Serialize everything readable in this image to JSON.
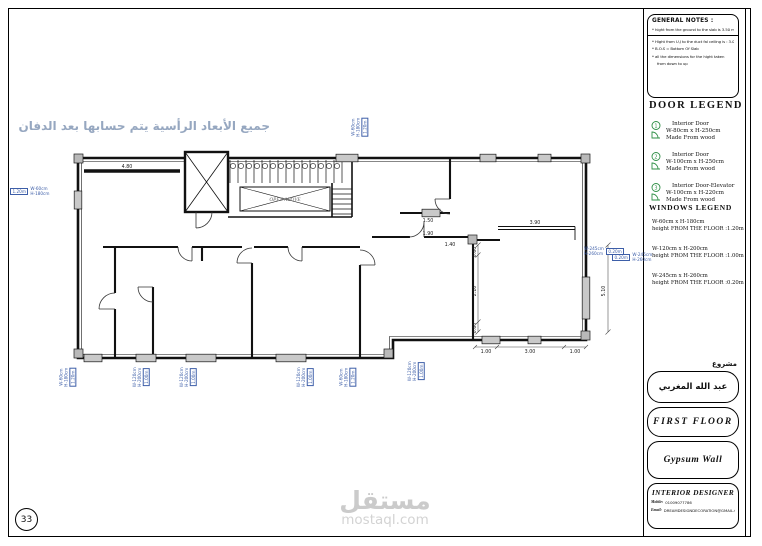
{
  "sheet": {
    "number": "33",
    "watermark_ar": "مستقل",
    "watermark_en": "mostaql.com"
  },
  "plan": {
    "note_arabic": "جميع الأبعاد الرأسية يتم حسابها بعد الدفان",
    "stair_label": "OPEN ABOVE",
    "dims": {
      "top_left": "4.80",
      "a": "1.50",
      "b": "1.90",
      "c": "1.40",
      "beam": "3.90",
      "v1": "0.60",
      "v2": "2.10",
      "v3": "0.60",
      "r1": "5.10",
      "b1": "1.00",
      "b2": "3.00",
      "b3": "1.00"
    },
    "window_tags": [
      {
        "l1": "W-60cm",
        "l2": "H-180cm",
        "h": "1.20m"
      },
      {
        "l1": "W-60cm",
        "l2": "H-180cm",
        "h": "1.20m"
      },
      {
        "l1": "W-60cm",
        "l2": "H-180cm",
        "h": "1.20m"
      },
      {
        "l1": "W-120cm",
        "l2": "H-200cm",
        "h": "1.00m"
      },
      {
        "l1": "W-120cm",
        "l2": "H-200cm",
        "h": "1.00m"
      },
      {
        "l1": "W-120cm",
        "l2": "H-200cm",
        "h": "1.00m"
      },
      {
        "l1": "W-60cm",
        "l2": "H-180cm",
        "h": "1.20m"
      },
      {
        "l1": "W-120cm",
        "l2": "H-200cm",
        "h": "1.00m"
      },
      {
        "l1": "W-245cm",
        "l2": "H-260cm",
        "h": "0.20m"
      },
      {
        "l1": "W-245cm",
        "l2": "H-260cm",
        "h": "0.20m"
      }
    ]
  },
  "panel": {
    "general_notes": {
      "title": "GENERAL NOTES :",
      "note1": "* hight from the ground to the slab is 3.50 m.",
      "note2": "* Hight from U.J to the duct fal ceiling is : 3.00/3.25 m.",
      "note3": "* B.O.S = Bottom Of Slab",
      "note4": "* all the dimensions for the hight taken",
      "note5": "from down to up"
    },
    "door_legend": {
      "title": "DOOR LEGEND",
      "items": [
        {
          "num": "1",
          "name": "Interior Door",
          "size": "W-80cm x H-250cm",
          "material": "Made From wood"
        },
        {
          "num": "2",
          "name": "Interior Door",
          "size": "W-100cm x H-250cm",
          "material": "Made From wood"
        },
        {
          "num": "3",
          "name": "Interior Door-Elevator",
          "size": "W-100cm x H-220cm",
          "material": "Made From wood"
        }
      ]
    },
    "windows_legend": {
      "title": "WINDOWS LEGEND",
      "items": [
        {
          "num": "1",
          "tag": "WIN",
          "size": "W-60cm x H-180cm",
          "height": "height FROM THE FLOOR :1.20m"
        },
        {
          "num": "2",
          "tag": "WIN",
          "size": "W-120cm x H-200cm",
          "height": "height FROM THE FLOOR :1.00m"
        },
        {
          "num": "3",
          "tag": "WIN",
          "size": "W-245cm x H-260cm",
          "height": "height FROM THE FLOOR :0.20m"
        }
      ]
    },
    "project": {
      "label": "مشروع",
      "name": "عبد الله المغربي"
    },
    "floor_title": "FIRST  FLOOR",
    "wall_type": "Gypsum Wall",
    "designer": {
      "title": "INTERIOR DESIGNER",
      "mobile_label": "Mobile:",
      "mobile": "01009077786",
      "email_label": "Email:",
      "email": "DREAMDESIGNDECORATION@GMAIL.COM"
    }
  },
  "colors": {
    "legend_green": "#2f8f46",
    "dim_blue": "#3d5ea8",
    "note_blue": "#96a7c0",
    "watermark_gray": "#cbcbcb"
  }
}
